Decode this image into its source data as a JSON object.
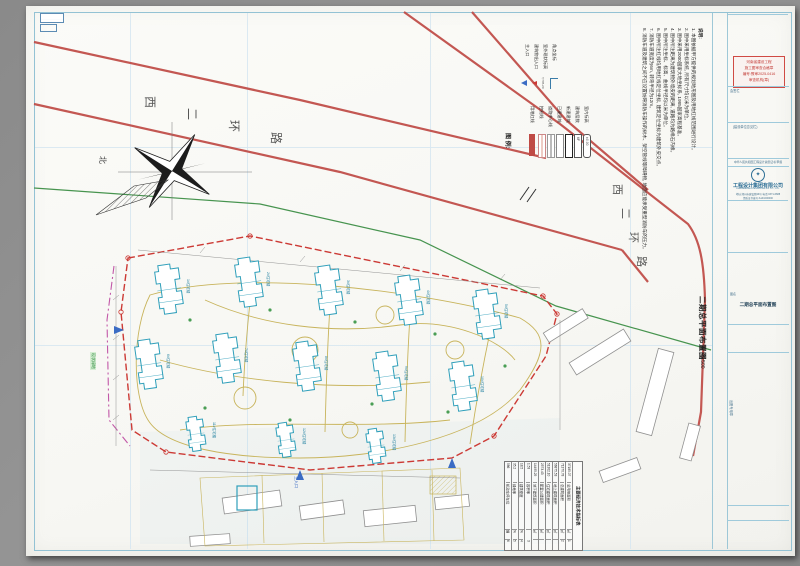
{
  "sheet": {
    "caption": "二期总平面布置图",
    "scale": "1:500",
    "road_name": "西二环路",
    "north_label": "北",
    "green_label": "现状绿地",
    "entrance_label": "主入口"
  },
  "legend": {
    "header": "图 例:",
    "marks": [
      {
        "label": "主入口"
      },
      {
        "label": "建筑物出入口"
      },
      {
        "label": "室外现状标高",
        "sample": "765.20"
      },
      {
        "label": "角点坐标",
        "sample": "X= Y="
      }
    ],
    "items": [
      {
        "label": "用地红线",
        "type": "red-solid"
      },
      {
        "label": "控制线",
        "type": "pink-line"
      },
      {
        "label": "道路中心线",
        "type": "center-line"
      },
      {
        "label": "已建建筑",
        "type": "existing-bldg"
      },
      {
        "label": "新建建筑",
        "type": "new-bldg"
      },
      {
        "label": "建筑层数",
        "type": "floors",
        "sample": "6F"
      },
      {
        "label": "室内标高",
        "type": "level",
        "sample": "±0.00"
      }
    ]
  },
  "notes": {
    "header": "说明:",
    "lines": [
      "1. 本图依据甲方提供的规划地形图及用地红线范围进行设计。",
      "2. 图中采用坐标系统, 所有尺寸均以米为单位。",
      "3. 图中采用2000国家大地坐标系, 1985国家高程基准。",
      "4. 图中所注距离为建筑物外墙皮的距离, 道路均为路缘石内缘。",
      "5. 图中所注坐标、标高、曲线半径均以米为单位。",
      "6. 图中所注红线均用地红线定位坐标, 建筑定位坐标为建筑外皮交点。",
      "7. 消防车道宽度为6m, 转弯半径为12m。",
      "8. 消防车道及建筑之间不应设置妨碍消防车操作的树木、架空管线等障碍物, 地面应能承受重型消防车的压力。"
    ]
  },
  "table": {
    "title": "主要经济技术指标表",
    "rows": [
      {
        "no": "1",
        "name": "总用地面积",
        "unit": "㎡",
        "value": "37185.07"
      },
      {
        "no": "2",
        "name": "总建筑面积",
        "unit": "㎡",
        "value": "71370.78"
      },
      {
        "no": "",
        "name": "地上建筑面积",
        "unit": "㎡",
        "value": "56875.53"
      },
      {
        "no": "",
        "name": "住宅建筑面积",
        "unit": "㎡",
        "value": "51302.10"
      },
      {
        "no": "",
        "name": "配套公建面积",
        "unit": "㎡",
        "value": "2573.43"
      },
      {
        "no": "",
        "name": "地下建筑面积",
        "unit": "㎡",
        "value": "14495.25"
      },
      {
        "no": "3",
        "name": "容积率",
        "unit": "",
        "value": "1.53"
      },
      {
        "no": "4",
        "name": "建筑密度",
        "unit": "%",
        "value": "18.5"
      },
      {
        "no": "5",
        "name": "绿地率",
        "unit": "%",
        "value": "35.2"
      },
      {
        "no": "6",
        "name": "机动车停车位",
        "unit": "辆",
        "value": "586"
      }
    ]
  },
  "plan": {
    "buildings": [
      "1#住宅楼",
      "2#住宅楼",
      "3#住宅楼",
      "4#住宅楼",
      "5#住宅楼",
      "6#住宅楼",
      "7#住宅楼",
      "8#住宅楼",
      "9#住宅楼",
      "10#住宅楼",
      "11#住宅楼",
      "12#住宅楼",
      "13#住宅楼"
    ],
    "corner_coords": [
      "X= Y=",
      "X= Y=",
      "X= Y=",
      "X= Y="
    ],
    "dims": [
      "36.00",
      "28.50",
      "24.00",
      "15.00",
      "R9.0",
      "12.00"
    ]
  },
  "titleblock": {
    "revision_headers": [
      "标记",
      "处数",
      "修改",
      "日期"
    ],
    "stamp_lines": [
      "河南省建设工程",
      "施工图审查合格章",
      "编号:豫审2025-0416",
      "审查机构(章)"
    ],
    "box1_label": "会签栏",
    "box2_label": "(建设单位意见栏)",
    "cert_line": "中华人民共和国工程设计资质证书 甲级",
    "company": {
      "name": "工程设计集团有限公司",
      "en": "ENGINEERING DESIGN GROUP CO., LTD.",
      "addr": "地址:郑州市建设路99号  电话:0371-6688",
      "cert": "资质证书编号:A141000000"
    },
    "sig_rows": [
      {
        "label": "设计总负责",
        "sig": "Mw"
      },
      {
        "label": "专业负责",
        "sig": "Jh"
      },
      {
        "label": "设  计",
        "sig": "Zk"
      },
      {
        "label": "校  对",
        "sig": "Lq"
      },
      {
        "label": "审  核",
        "sig": "Wx"
      },
      {
        "label": "审  定",
        "sig": "Ty"
      }
    ],
    "info_rows": [
      {
        "label": "建设单位",
        "value": "置业有限公司"
      },
      {
        "label": "工程名称",
        "value": "家园住宅小区二期工程"
      },
      {
        "label": "子项名称",
        "value": "总平面"
      }
    ],
    "drawing_label": "图名",
    "drawing_name": "二期总平面布置图",
    "meta": [
      {
        "k": "比例",
        "v": "1:500"
      },
      {
        "k": "图别",
        "v": "总图"
      },
      {
        "k": "日期",
        "v": "2025.06"
      },
      {
        "k": "图号",
        "v": "总-02"
      }
    ],
    "side_label": "出图专用章"
  }
}
